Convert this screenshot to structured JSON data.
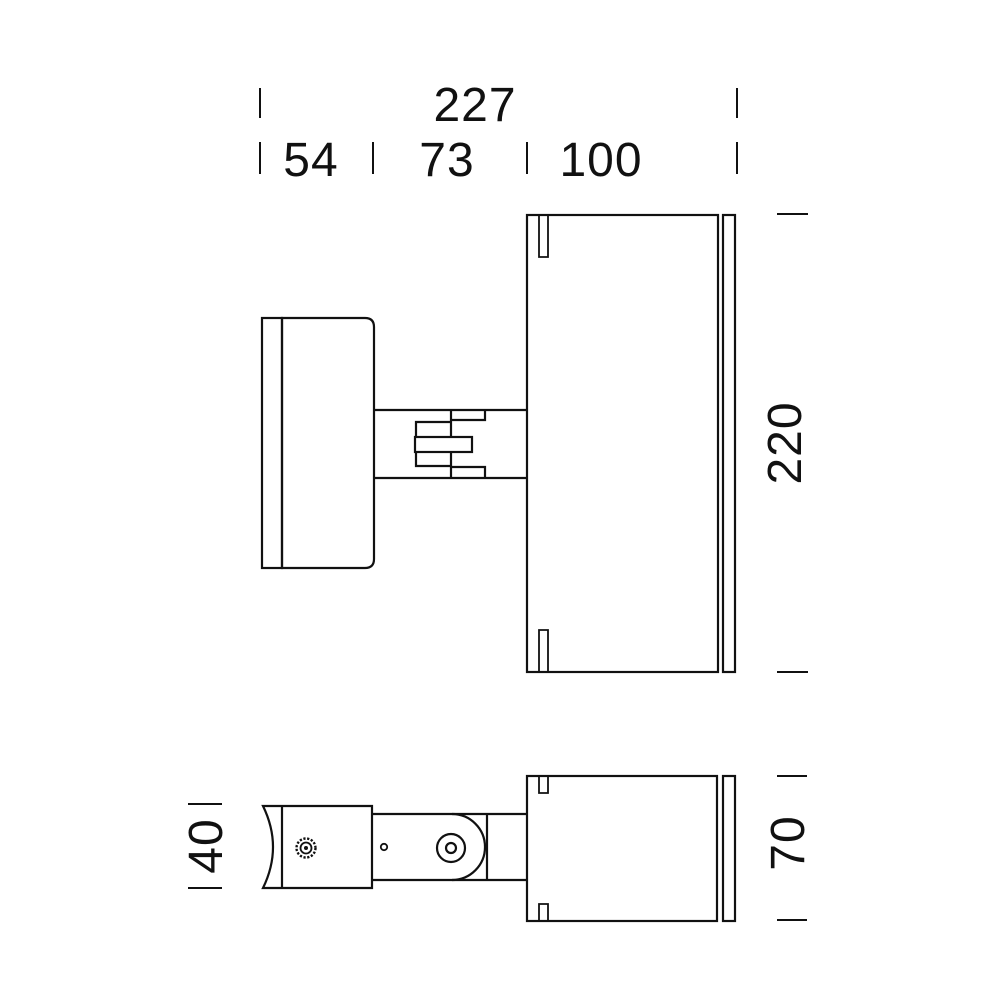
{
  "drawing": {
    "type": "technical-dimension-drawing",
    "views": {
      "side_view": "luminaire side elevation with wall bracket, adjustable arm joint and cylindrical head",
      "bottom_view": "luminaire bottom view with clamp screw, hinge pivot and cylindrical head"
    },
    "dimensions": {
      "overall_width": "227",
      "bracket_width": "54",
      "arm_width": "73",
      "head_width": "100",
      "overall_height": "220",
      "bracket_height": "40",
      "head_depth": "70"
    },
    "units": "mm",
    "line_color": "#111111",
    "background_color": "#ffffff"
  }
}
